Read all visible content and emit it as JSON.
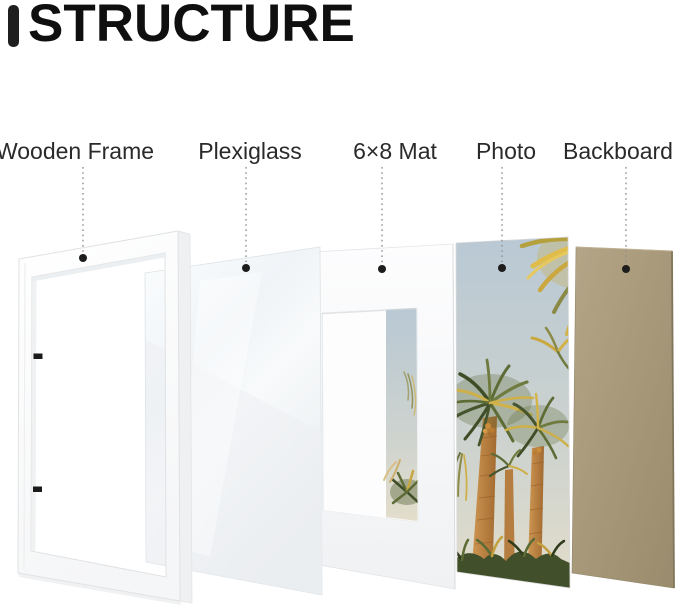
{
  "header": {
    "title": "STRUCTURE"
  },
  "layers": [
    {
      "label": "Wooden Frame"
    },
    {
      "label": "Plexiglass"
    },
    {
      "label": "6×8 Mat"
    },
    {
      "label": "Photo"
    },
    {
      "label": "Backboard"
    }
  ],
  "colors": {
    "title_text": "#0f0f0f",
    "title_bar": "#1f1f1f",
    "label_text": "#2a2a2a",
    "callout_line": "#909090",
    "callout_dot": "#1d1d1d",
    "frame_white": "#ffffff",
    "plexiglass_tint": "#eef2f5",
    "mat_white": "#fbfcfd",
    "photo_sky": "#b8c8d4",
    "palm_green": "#46552d",
    "palm_gold": "#d3b348",
    "trunk_orange": "#bf8042",
    "backboard_tan": "#a69878",
    "backboard_edge": "#80755a"
  }
}
